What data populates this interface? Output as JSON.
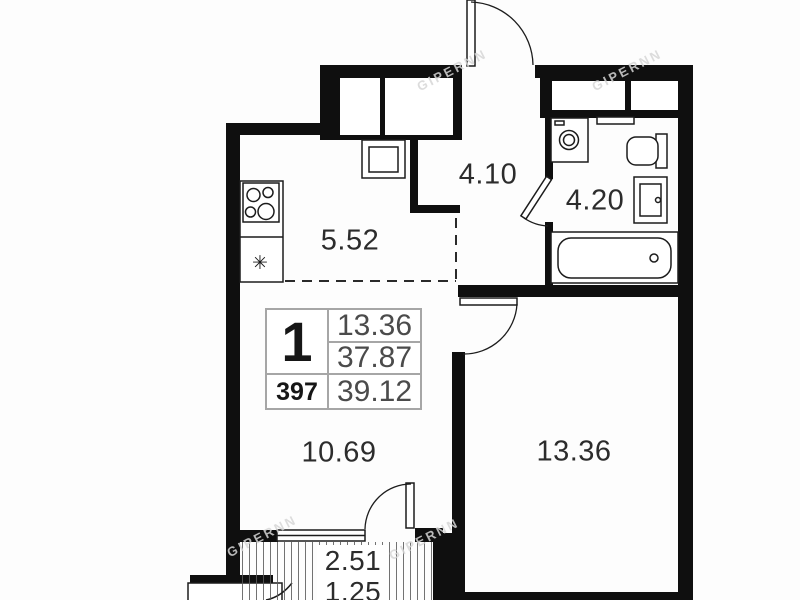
{
  "labels": {
    "kitchen": "5.52",
    "hallway": "4.10",
    "bathroom": "4.20",
    "living": "10.69",
    "bedroom": "13.36",
    "balcony_line1": "2.51",
    "balcony_line2": "1.25"
  },
  "info_table": {
    "rooms_count": "1",
    "unit_number": "397",
    "living_area": "13.36",
    "area_without_balcony": "37.87",
    "total_area": "39.12"
  },
  "icons": {
    "fridge_snowflake": "✳"
  },
  "watermark": {
    "text": "GIPERNN"
  },
  "colors": {
    "wall": "#0f0f0f",
    "line": "#1c1c1c",
    "label_text": "#2c2c2c",
    "table_border": "#a6a6a6",
    "table_number": "#4b4b4b",
    "background": "#fdfdfd"
  }
}
